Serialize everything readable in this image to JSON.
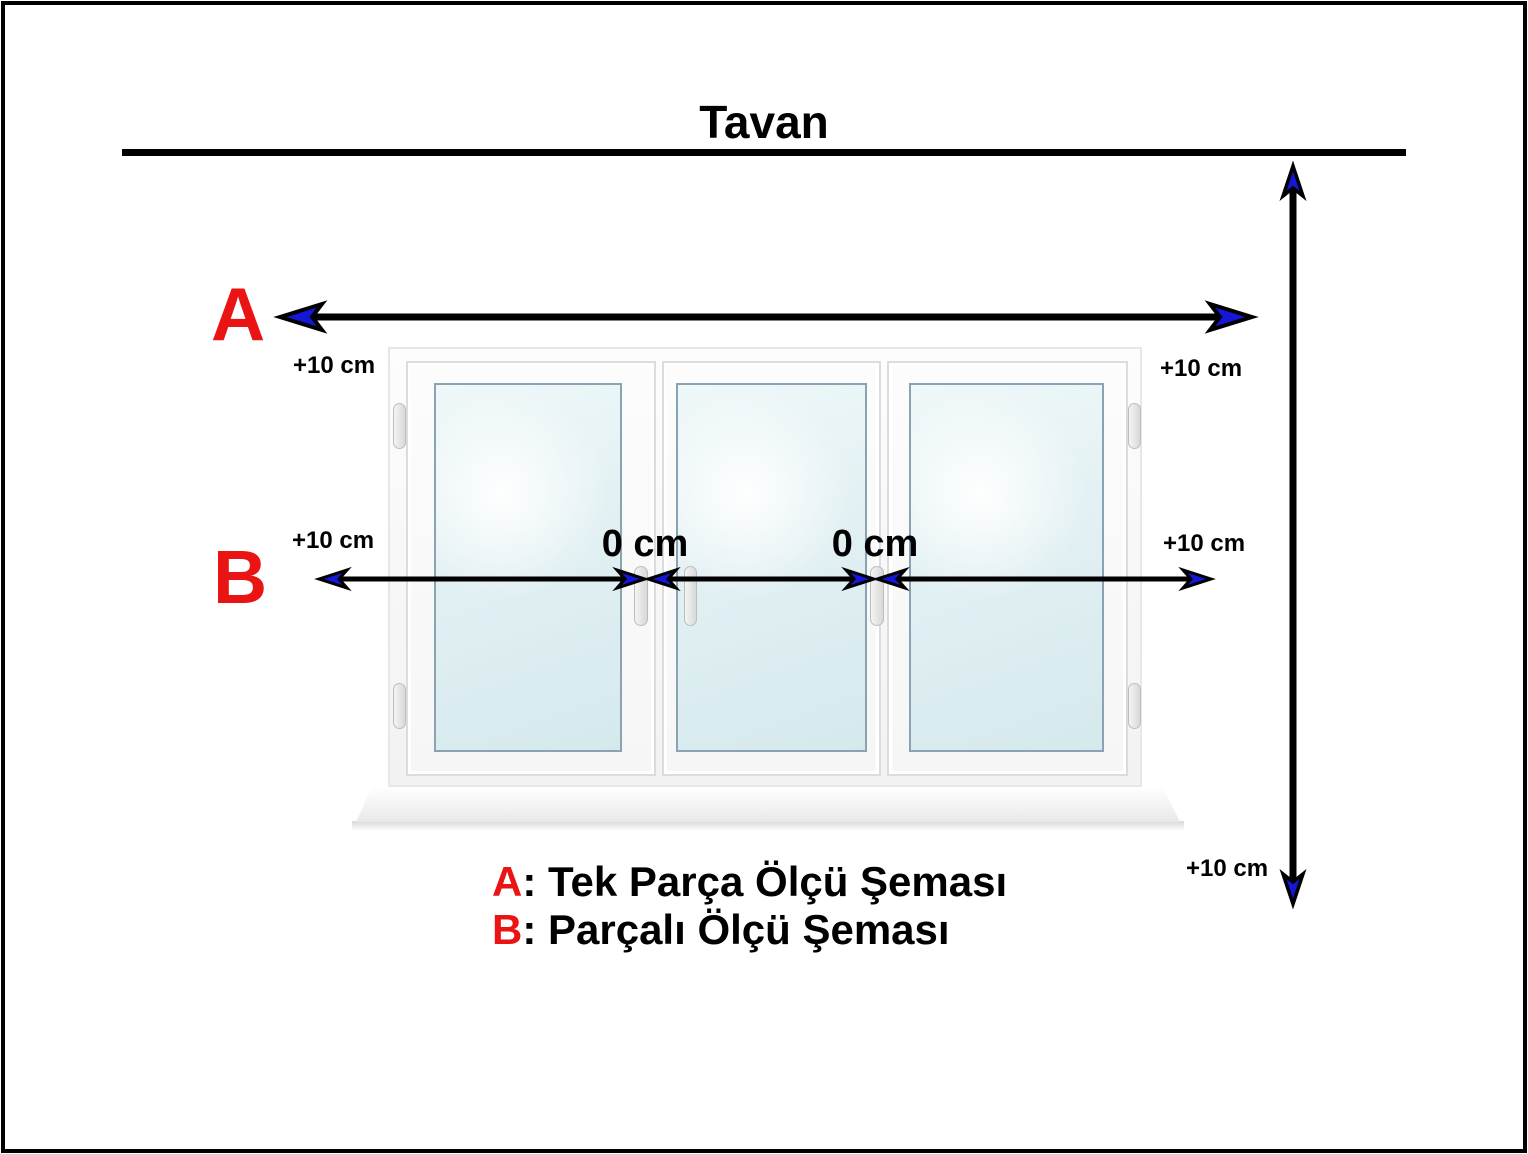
{
  "title": "Tavan",
  "marker_a": "A",
  "marker_b": "B",
  "labels": {
    "a_left": "+10 cm",
    "a_right": "+10 cm",
    "b_left": "+10 cm",
    "b_right": "+10 cm",
    "v_bottom": "+10 cm",
    "gap_left": "0 cm",
    "gap_right": "0 cm"
  },
  "legend": {
    "a_key": "A",
    "a_text": ": Tek Parça Ölçü Şeması",
    "b_key": "B",
    "b_text": ": Parçalı Ölçü Şeması"
  },
  "colors": {
    "marker_red": "#EA1414",
    "arrow_blue": "#1616D6",
    "line_black": "#000000"
  }
}
